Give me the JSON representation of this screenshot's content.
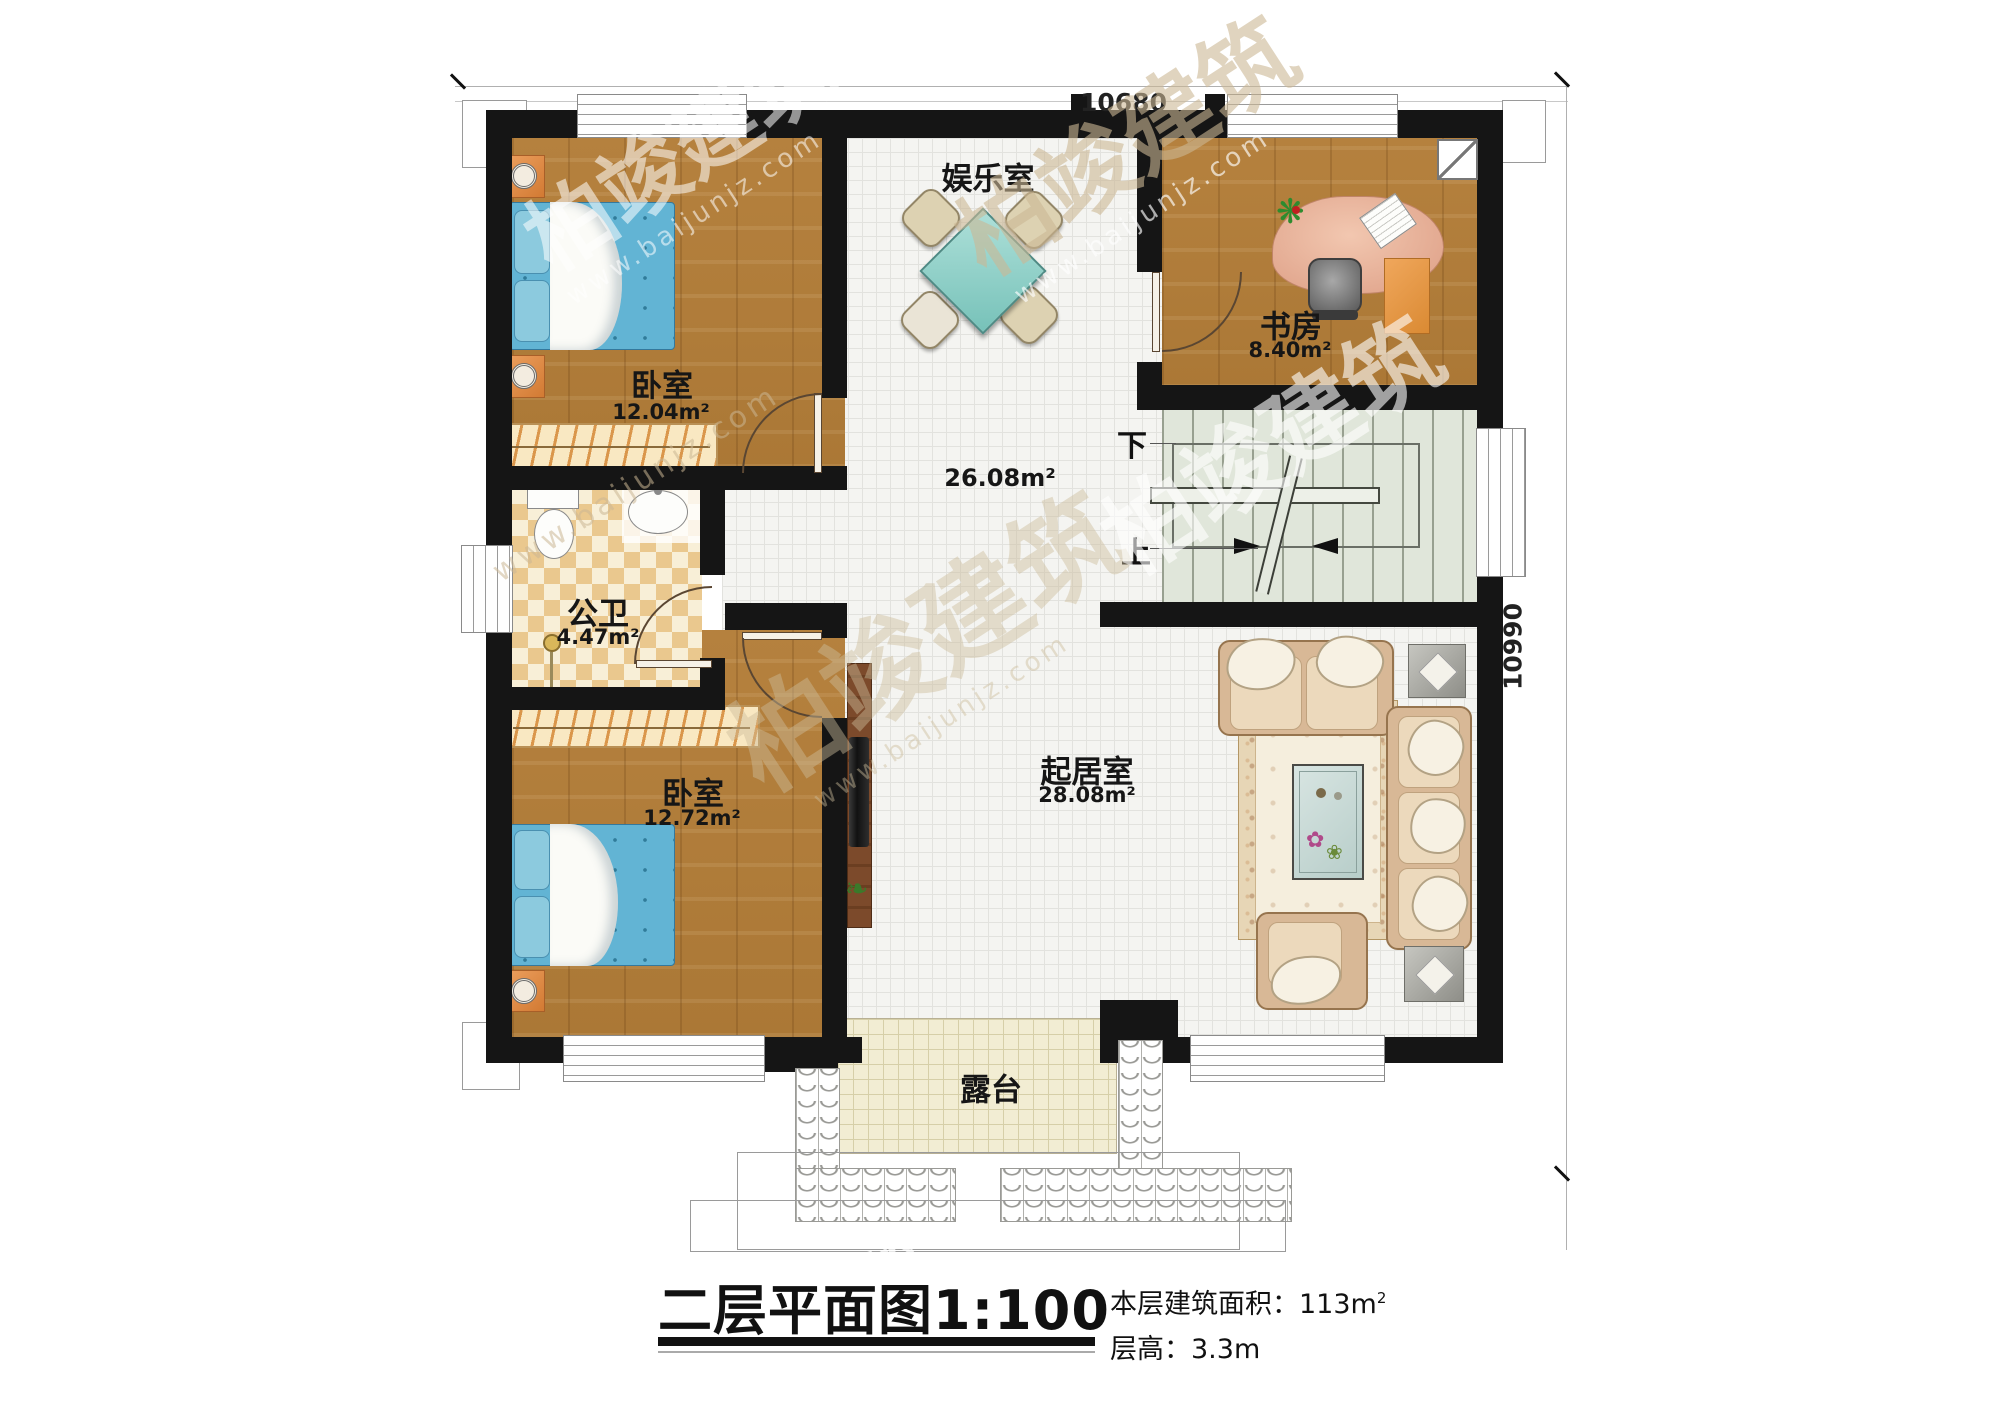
{
  "plan": {
    "dim_top": "10680",
    "dim_right": "10990",
    "rooms": [
      {
        "name": "卧室",
        "area": "12.04m²"
      },
      {
        "name": "娱乐室",
        "area": "26.08m²"
      },
      {
        "name": "书房",
        "area": "8.40m²"
      },
      {
        "name": "公卫",
        "area": "4.47m²"
      },
      {
        "name": "卧室",
        "area": "12.72m²"
      },
      {
        "name": "起居室",
        "area": "28.08m²"
      },
      {
        "name": "露台",
        "area": ""
      }
    ],
    "stairs_down": "下",
    "stairs_up": "上"
  },
  "title_block": {
    "title": "二层平面图",
    "scale": "1:100",
    "area_label": "本层建筑面积：113m",
    "area_sup": "2",
    "height_label": "层高：3.3m"
  },
  "watermark": {
    "brand": "柏竣建筑",
    "url": "www.baijunjz.com"
  },
  "colors": {
    "wall": "#151515",
    "wood": "#b5813e",
    "tile_white": "#f4f4f1",
    "checker": "#eac88e",
    "stair_floor": "#e0e6da",
    "terrace": "#f2edd3",
    "bed_blue": "#62b4d4",
    "accent_orange": "#e08848",
    "table_teal": "#9fd6d0",
    "desk_salmon": "#e2a28c",
    "sofa_beige": "#d9bb9b"
  }
}
